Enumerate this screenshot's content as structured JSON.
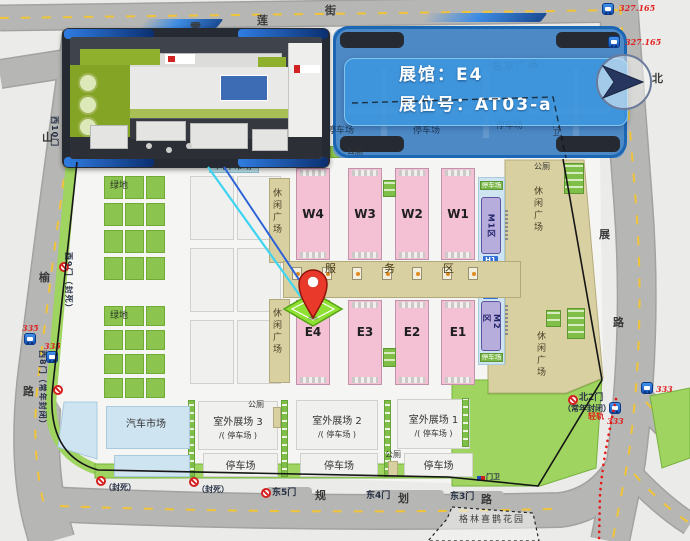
{
  "banner": {
    "line1": "展馆：E4",
    "line2": "展位号：AT03-a"
  },
  "compass": {
    "north": "北"
  },
  "plaza": {
    "name": "名京广场",
    "parking": [
      "停车场",
      "停车场",
      "停车场"
    ]
  },
  "streets": {
    "top": [
      "雪",
      "莲",
      "街"
    ],
    "left": [
      "山",
      "榆",
      "路"
    ],
    "right": [
      "展",
      "路"
    ],
    "bottom": [
      "规",
      "划",
      "路"
    ]
  },
  "halls": {
    "west": [
      "W4",
      "W3",
      "W2",
      "W1"
    ],
    "east": [
      "E4",
      "E3",
      "E2",
      "E1"
    ]
  },
  "m_zone": {
    "m1": "M1区",
    "m2": "M2区",
    "h1": "H1",
    "h2": "H2",
    "parking_top": "停车场",
    "parking_bottom": "停车场"
  },
  "outdoor": [
    {
      "name": "室外展场 3",
      "sub": "/( 停车场 )",
      "parking": "停车场"
    },
    {
      "name": "室外展场 2",
      "sub": "/( 停车场 )",
      "parking": "停车场"
    },
    {
      "name": "室外展场 1",
      "sub": "/( 停车场 )",
      "parking": "停车场"
    }
  ],
  "car_market": {
    "top_label": "汽车市场",
    "bottom_label": "汽车市场"
  },
  "labels": {
    "green_space": "绿地",
    "leisure": "休闲广场",
    "service": "服务区",
    "toilet": "公厕",
    "garden": "格林喜鹊花园",
    "light_rail": "轻轨"
  },
  "gates": {
    "e5": "东5门",
    "e4": "东4门",
    "e3": "东3门",
    "n2": "北2门",
    "n2_note": "（常年封闭）",
    "w10": "西10门",
    "w9": "西9门（封死）",
    "w8": "西8门（常年封闭）",
    "sealed1": "（封死）",
    "sealed2": "（封死）",
    "guard_top": "门卫",
    "guard_bottom": "门卫"
  },
  "bus_stops": [
    {
      "route": "327.165"
    },
    {
      "route": "327.165"
    },
    {
      "route": "335"
    },
    {
      "route": "335"
    },
    {
      "route": "333"
    },
    {
      "route": "333"
    }
  ],
  "colors": {
    "banner_blue": "#3f96dc",
    "overlay_blue": "#2a76c6",
    "hall_pink": "#f3c0d4",
    "venue_green": "#8cc450",
    "leisure_tan": "#d9d0a2",
    "pin_red": "#e8392b",
    "route_text_red": "#e02222",
    "bus_icon_blue": "#1750b4"
  }
}
